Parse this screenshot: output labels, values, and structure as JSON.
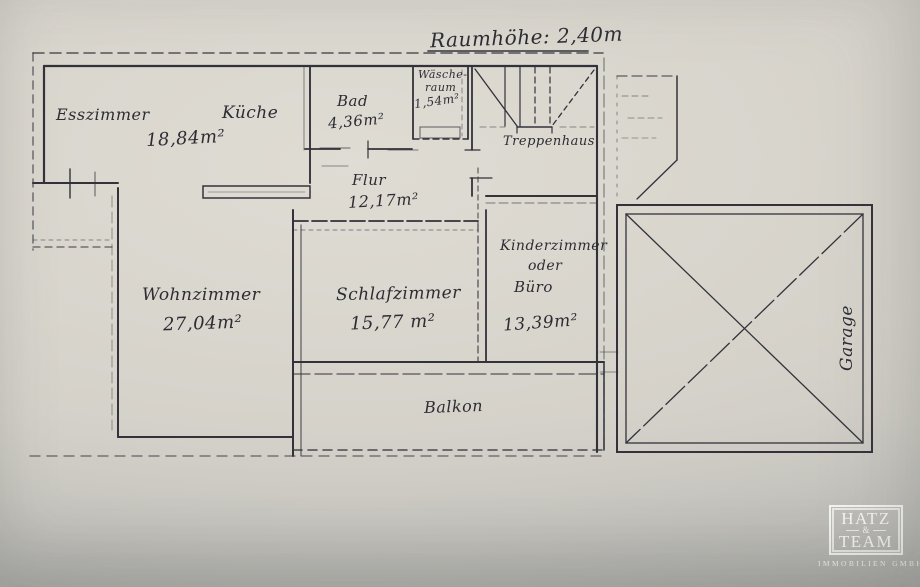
{
  "colors": {
    "paper": "#d7d4cc",
    "ink": "#33323a",
    "photo_gray": "#a1a29f",
    "logo_white": "#f3f3f1"
  },
  "annotation": {
    "room_height": "Raumhöhe: 2,40m"
  },
  "rooms": {
    "esszimmer": {
      "name": "Esszimmer"
    },
    "kueche": {
      "name": "Küche",
      "area": "18,84m²"
    },
    "bad": {
      "name": "Bad",
      "area": "4,36m²"
    },
    "waescheraum": {
      "line1": "Wäsche-",
      "line2": "raum",
      "area": "1,54m²"
    },
    "treppenhaus": {
      "name": "Treppenhaus"
    },
    "flur": {
      "name": "Flur",
      "area": "12,17m²"
    },
    "wohnzimmer": {
      "name": "Wohnzimmer",
      "area": "27,04m²"
    },
    "schlafzimmer": {
      "name": "Schlafzimmer",
      "area": "15,77 m²"
    },
    "kinderzimmer": {
      "line1": "Kinderzimmer",
      "line2": "oder",
      "line3": "Büro",
      "area": "13,39m²"
    },
    "balkon": {
      "name": "Balkon"
    },
    "garage": {
      "name": "Garage"
    }
  },
  "logo": {
    "top": "HATZ",
    "amp": "&",
    "bottom": "TEAM",
    "subtitle": "IMMOBILIEN GMBH"
  }
}
